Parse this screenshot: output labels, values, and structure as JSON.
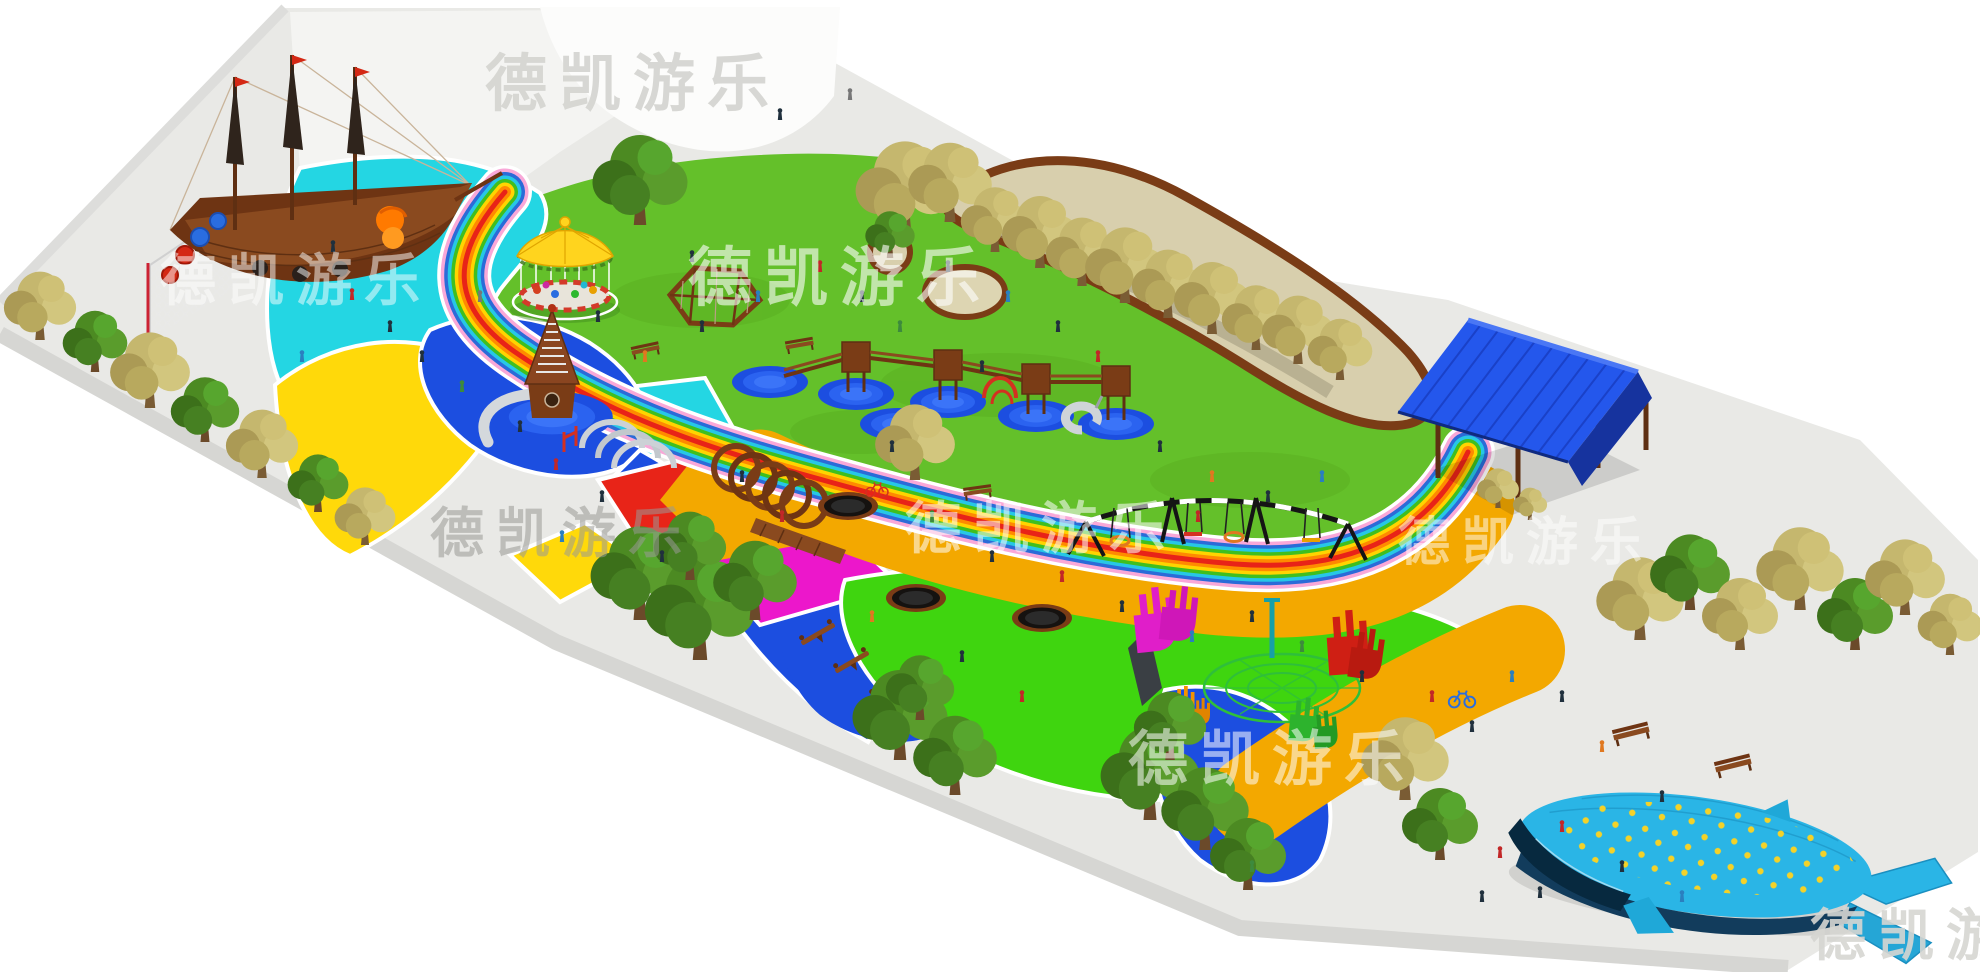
{
  "watermark": {
    "text": "德凯游乐",
    "color_light": "#ffffff",
    "color_grey": "#d6d6d2",
    "color_dark": "#9a9a96"
  },
  "palette": {
    "background": "#ffffff",
    "plaza": "#e9e9e6",
    "plaza_light": "#f4f4f2",
    "lawn": "#64c02a",
    "green_zone": "#3fd50f",
    "cyan": "#24d6e3",
    "blue": "#1c4ee0",
    "yellow": "#ffd90a",
    "amber": "#f3a800",
    "red": "#e82418",
    "magenta": "#ec17cb",
    "sand": "#d8cfad",
    "wood": "#8a4a1f",
    "wood_dark": "#5e2f12",
    "roof_blue": "#2457ec",
    "steel": "#ccd1d6",
    "net_green": "#2fbf3a",
    "whale": "#2ab5e6",
    "whale_belly": "#123c5c",
    "whale_mouth": "#07293f",
    "whale_dot": "#ffd41e",
    "rainbow_red": "#e82318",
    "rainbow_orange": "#ff8a00",
    "rainbow_yellow": "#ffd400",
    "rainbow_green": "#3fbf1f",
    "rainbow_cyan": "#27c7e6",
    "rainbow_blue": "#2b6bd8",
    "rainbow_pink": "#f9a8d8"
  },
  "features": {
    "pirate_ship": "pirate-ship-playset",
    "carousel": "carousel",
    "cone_tower": "cone-tower-slide",
    "arch_tunnels": "steel-arch-tunnels",
    "wood_rings": "wooden-ring-tunnel",
    "tower_bridges": "tower-bridge-complex",
    "swing_set": "swing-set",
    "trampolines": "in-ground-trampolines",
    "net_spiral": "spiral-net-climber",
    "hand_sculptures": "hand-sculptures",
    "seesaws": "seesaws",
    "pavilion": "blue-roof-pavilion",
    "whale": "whale-sculpture",
    "rainbow_path": "rainbow-path",
    "planter": "tree-planter-bed"
  }
}
